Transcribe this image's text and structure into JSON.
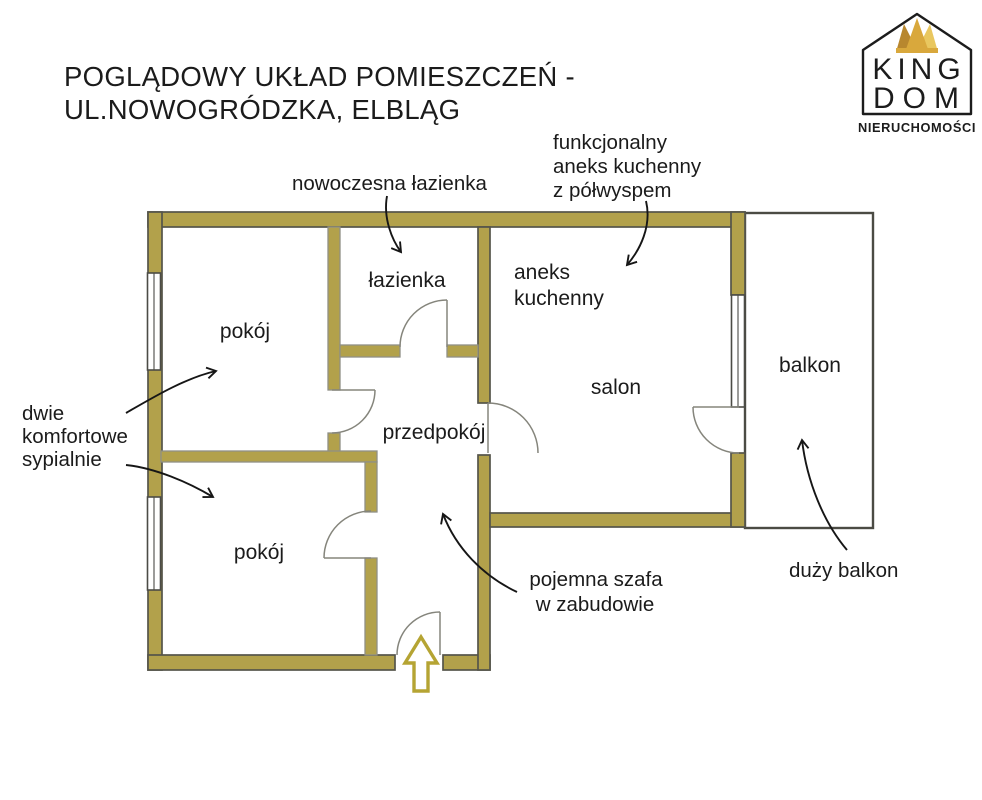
{
  "title": {
    "line1": "POGLĄDOWY UKŁAD POMIESZCZEŃ -",
    "line2": "UL.NOWOGRÓDZKA, ELBLĄG"
  },
  "logo": {
    "brand_top": "KING",
    "brand_bottom": "DOM",
    "subtitle": "NIERUCHOMOŚCI"
  },
  "rooms": {
    "room1": "pokój",
    "bathroom": "łazienka",
    "kitchenette_line1": "aneks",
    "kitchenette_line2": "kuchenny",
    "living": "salon",
    "hallway": "przedpokój",
    "room2": "pokój",
    "balcony": "balkon"
  },
  "annotations": {
    "bathroom": {
      "line1": "nowoczesna łazienka"
    },
    "kitchenette": {
      "line1": "funkcjonalny",
      "line2": "aneks kuchenny",
      "line3": "z półwyspem"
    },
    "bedrooms": {
      "line1": "dwie",
      "line2": "komfortowe",
      "line3": "sypialnie"
    },
    "wardrobe": {
      "line1": "pojemna szafa",
      "line2": "w zabudowie"
    },
    "balcony": {
      "line1": "duży balkon"
    }
  },
  "colors": {
    "wall": "#b2a14b",
    "wall_outline": "#55544a",
    "wall_inner": "#8f8f85",
    "door": "#85857c",
    "window_frame": "#4c4c46",
    "balcony_border": "#4b4b44",
    "ink": "#1b1b1b",
    "entrance_arrow": "#b5a433",
    "gold_dark": "#b8872e",
    "gold": "#d9a83c",
    "gold_light": "#e9c75f",
    "logo_ink": "#1c1c1c"
  }
}
